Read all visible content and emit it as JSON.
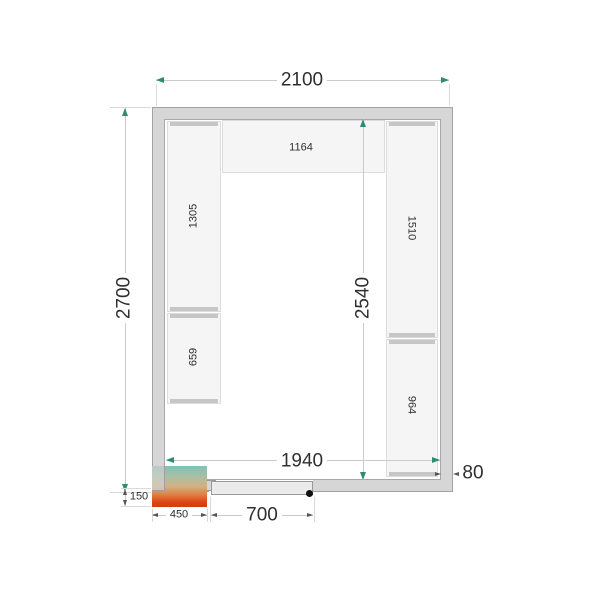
{
  "dims": {
    "outer_width": "2100",
    "outer_height": "2700",
    "inner_width": "1940",
    "inner_height": "2540",
    "wall_thickness": "80",
    "door_opening": "700",
    "unit_width": "450",
    "unit_protrusion": "150"
  },
  "shelves": {
    "top": "1164",
    "left_upper": "1305",
    "left_lower": "659",
    "right_upper": "1510",
    "right_lower": "964"
  },
  "colors": {
    "wall_fill": "#d6d6d6",
    "wall_line": "#a2a2a2",
    "shelf_fill": "#f5f5f5",
    "shelf_edge": "#c6c6c6",
    "dimension_line": "#cbcbcb",
    "arrow_teal": "#2e8b74",
    "arrow_dark": "#555555",
    "unit_gradient_top": "#7fc2b8",
    "unit_gradient_mid": "#d2b183",
    "unit_gradient_bottom": "#d23c10",
    "door_dot": "#111111"
  }
}
